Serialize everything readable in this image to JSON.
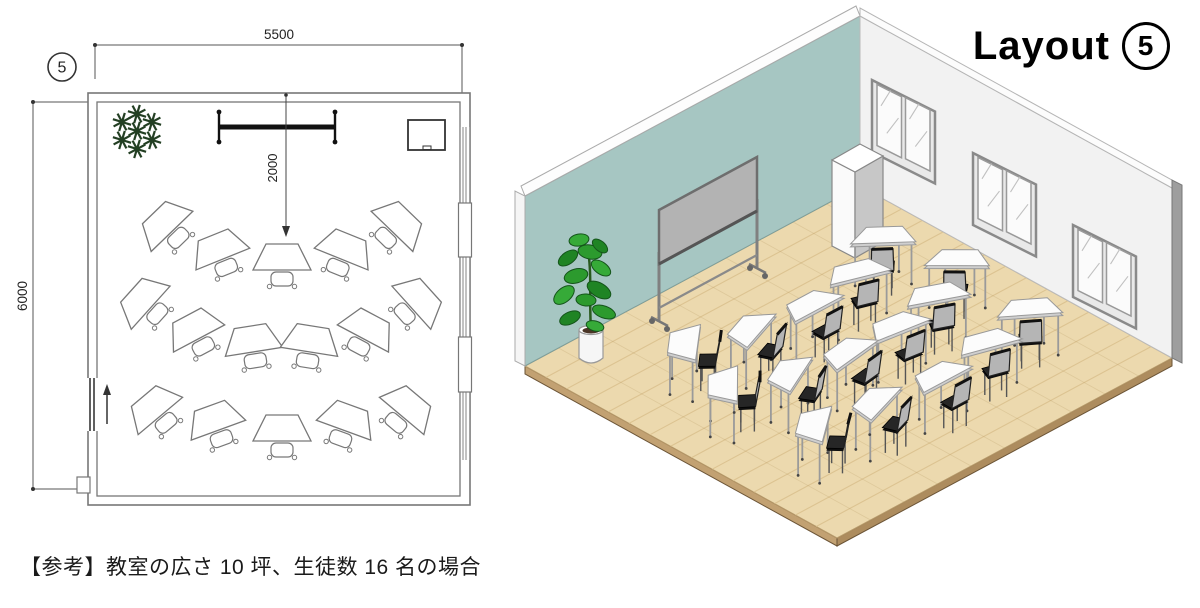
{
  "caption": "【参考】教室の広さ 10 坪、生徒数 16 名の場合",
  "title": {
    "text": "Layout",
    "number": "5"
  },
  "floor_plan": {
    "label_number": "5",
    "dimensions": {
      "width_mm": "5500",
      "depth_mm": "6000",
      "board_offset_mm": "2000"
    },
    "student_count": 16,
    "rows": [
      5,
      6,
      5
    ],
    "desks": [
      {
        "x": 163,
        "y": 222,
        "rot": -44
      },
      {
        "x": 218,
        "y": 247,
        "rot": -22
      },
      {
        "x": 282,
        "y": 257,
        "rot": 0
      },
      {
        "x": 346,
        "y": 247,
        "rot": 22
      },
      {
        "x": 401,
        "y": 222,
        "rot": 44
      },
      {
        "x": 141,
        "y": 299,
        "rot": -48
      },
      {
        "x": 193,
        "y": 327,
        "rot": -28
      },
      {
        "x": 252,
        "y": 339,
        "rot": -9
      },
      {
        "x": 311,
        "y": 339,
        "rot": 9
      },
      {
        "x": 369,
        "y": 327,
        "rot": 28
      },
      {
        "x": 421,
        "y": 299,
        "rot": 48
      },
      {
        "x": 152,
        "y": 406,
        "rot": -40
      },
      {
        "x": 214,
        "y": 418,
        "rot": -20
      },
      {
        "x": 282,
        "y": 428,
        "rot": 0
      },
      {
        "x": 348,
        "y": 418,
        "rot": 20
      },
      {
        "x": 410,
        "y": 406,
        "rot": 40
      }
    ],
    "board": {
      "x1": 219,
      "x2": 335,
      "y": 127
    },
    "cabinet": {
      "x": 408,
      "y": 120,
      "w": 37,
      "h": 30
    },
    "plant": {
      "x": 137,
      "y": 131
    }
  },
  "iso_view": {
    "desk_count": 16,
    "window_count": 3,
    "windows": [
      {
        "x": 372,
        "y": 80
      },
      {
        "x": 473,
        "y": 153
      },
      {
        "x": 573,
        "y": 225
      }
    ],
    "colors": {
      "wall_teal": "#a6c6c2",
      "wall_white": "#f2f2f2",
      "wall_edge": "#9e9e9e",
      "floor_wood": "#ecd9ae",
      "floor_seam": "#dcc391",
      "floor_edge": "#bf9d6c",
      "desk_top": "#fcfcfc",
      "desk_leg": "#9a9a9a",
      "chair_seat": "#262626",
      "chair_back": "#b5b5b5",
      "board_panel": "#b3b3b3",
      "board_frame": "#6e6e6e",
      "plant_green": "#2c9a2e",
      "pot_white": "#f6f6f6"
    }
  }
}
